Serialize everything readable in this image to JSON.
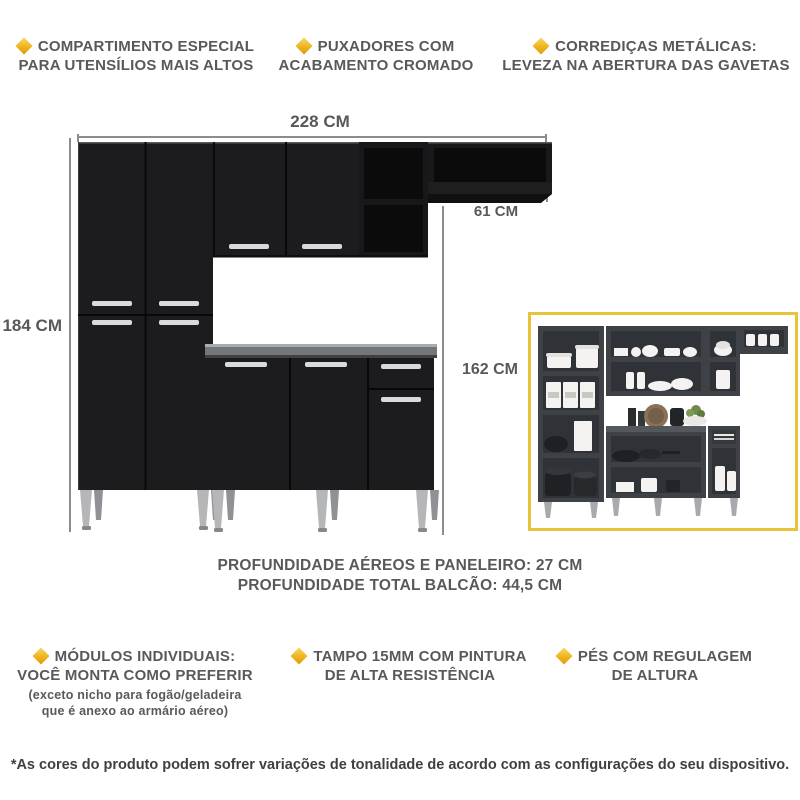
{
  "colors": {
    "accent_gold": "#EFB41B",
    "text_gray": "#58595B",
    "cabinet_black": "#1C1C1E",
    "countertop_gray": "#747779",
    "dimension_line_gray": "#8B8C8E",
    "inset_border_yellow": "#E8C33C",
    "inset_cabinet_gray": "#3E4146",
    "handle_chrome": "#D8DADC"
  },
  "icons": {
    "feature_bullet": "diamond-icon"
  },
  "features_top": [
    {
      "line1": "COMPARTIMENTO ESPECIAL",
      "line2": "PARA UTENSÍLIOS MAIS ALTOS"
    },
    {
      "line1": "PUXADORES COM",
      "line2": "ACABAMENTO CROMADO"
    },
    {
      "line1": "CORREDIÇAS METÁLICAS:",
      "line2": "LEVEZA NA ABERTURA DAS GAVETAS"
    }
  ],
  "dimensions": {
    "total_width": "228 CM",
    "shelf_width": "61 CM",
    "left_height": "184 CM",
    "right_height": "162 CM"
  },
  "depth_info": {
    "line1": "PROFUNDIDADE AÉREOS E PANELEIRO: 27 CM",
    "line2": "PROFUNDIDADE TOTAL BALCÃO: 44,5 CM"
  },
  "features_bottom": [
    {
      "line1": "MÓDULOS INDIVIDUAIS:",
      "line2": "VOCÊ MONTA COMO PREFERIR",
      "note1": "(exceto nicho para fogão/geladeira",
      "note2": "que é anexo ao armário aéreo)"
    },
    {
      "line1": "TAMPO 15MM COM PINTURA",
      "line2": "DE ALTA RESISTÊNCIA"
    },
    {
      "line1": "PÉS COM REGULAGEM",
      "line2": "DE ALTURA"
    }
  ],
  "footer": {
    "disclaimer": "*As cores do produto podem sofrer variações de tonalidade de acordo com as configurações do seu dispositivo."
  }
}
